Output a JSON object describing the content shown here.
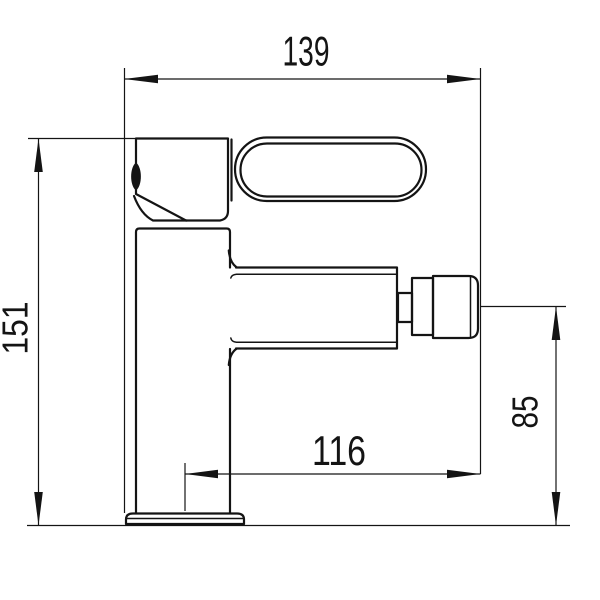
{
  "drawing": {
    "background_color": "#ffffff",
    "line_color": "#141414",
    "subject": "single-lever faucet side-view technical drawing",
    "dimensions": {
      "overall_depth": {
        "value": "139",
        "orientation": "horizontal"
      },
      "total_height": {
        "value": "151",
        "orientation": "vertical"
      },
      "spout_reach": {
        "value": "116",
        "orientation": "horizontal"
      },
      "spout_outlet_height": {
        "value": "85",
        "orientation": "vertical"
      }
    }
  }
}
